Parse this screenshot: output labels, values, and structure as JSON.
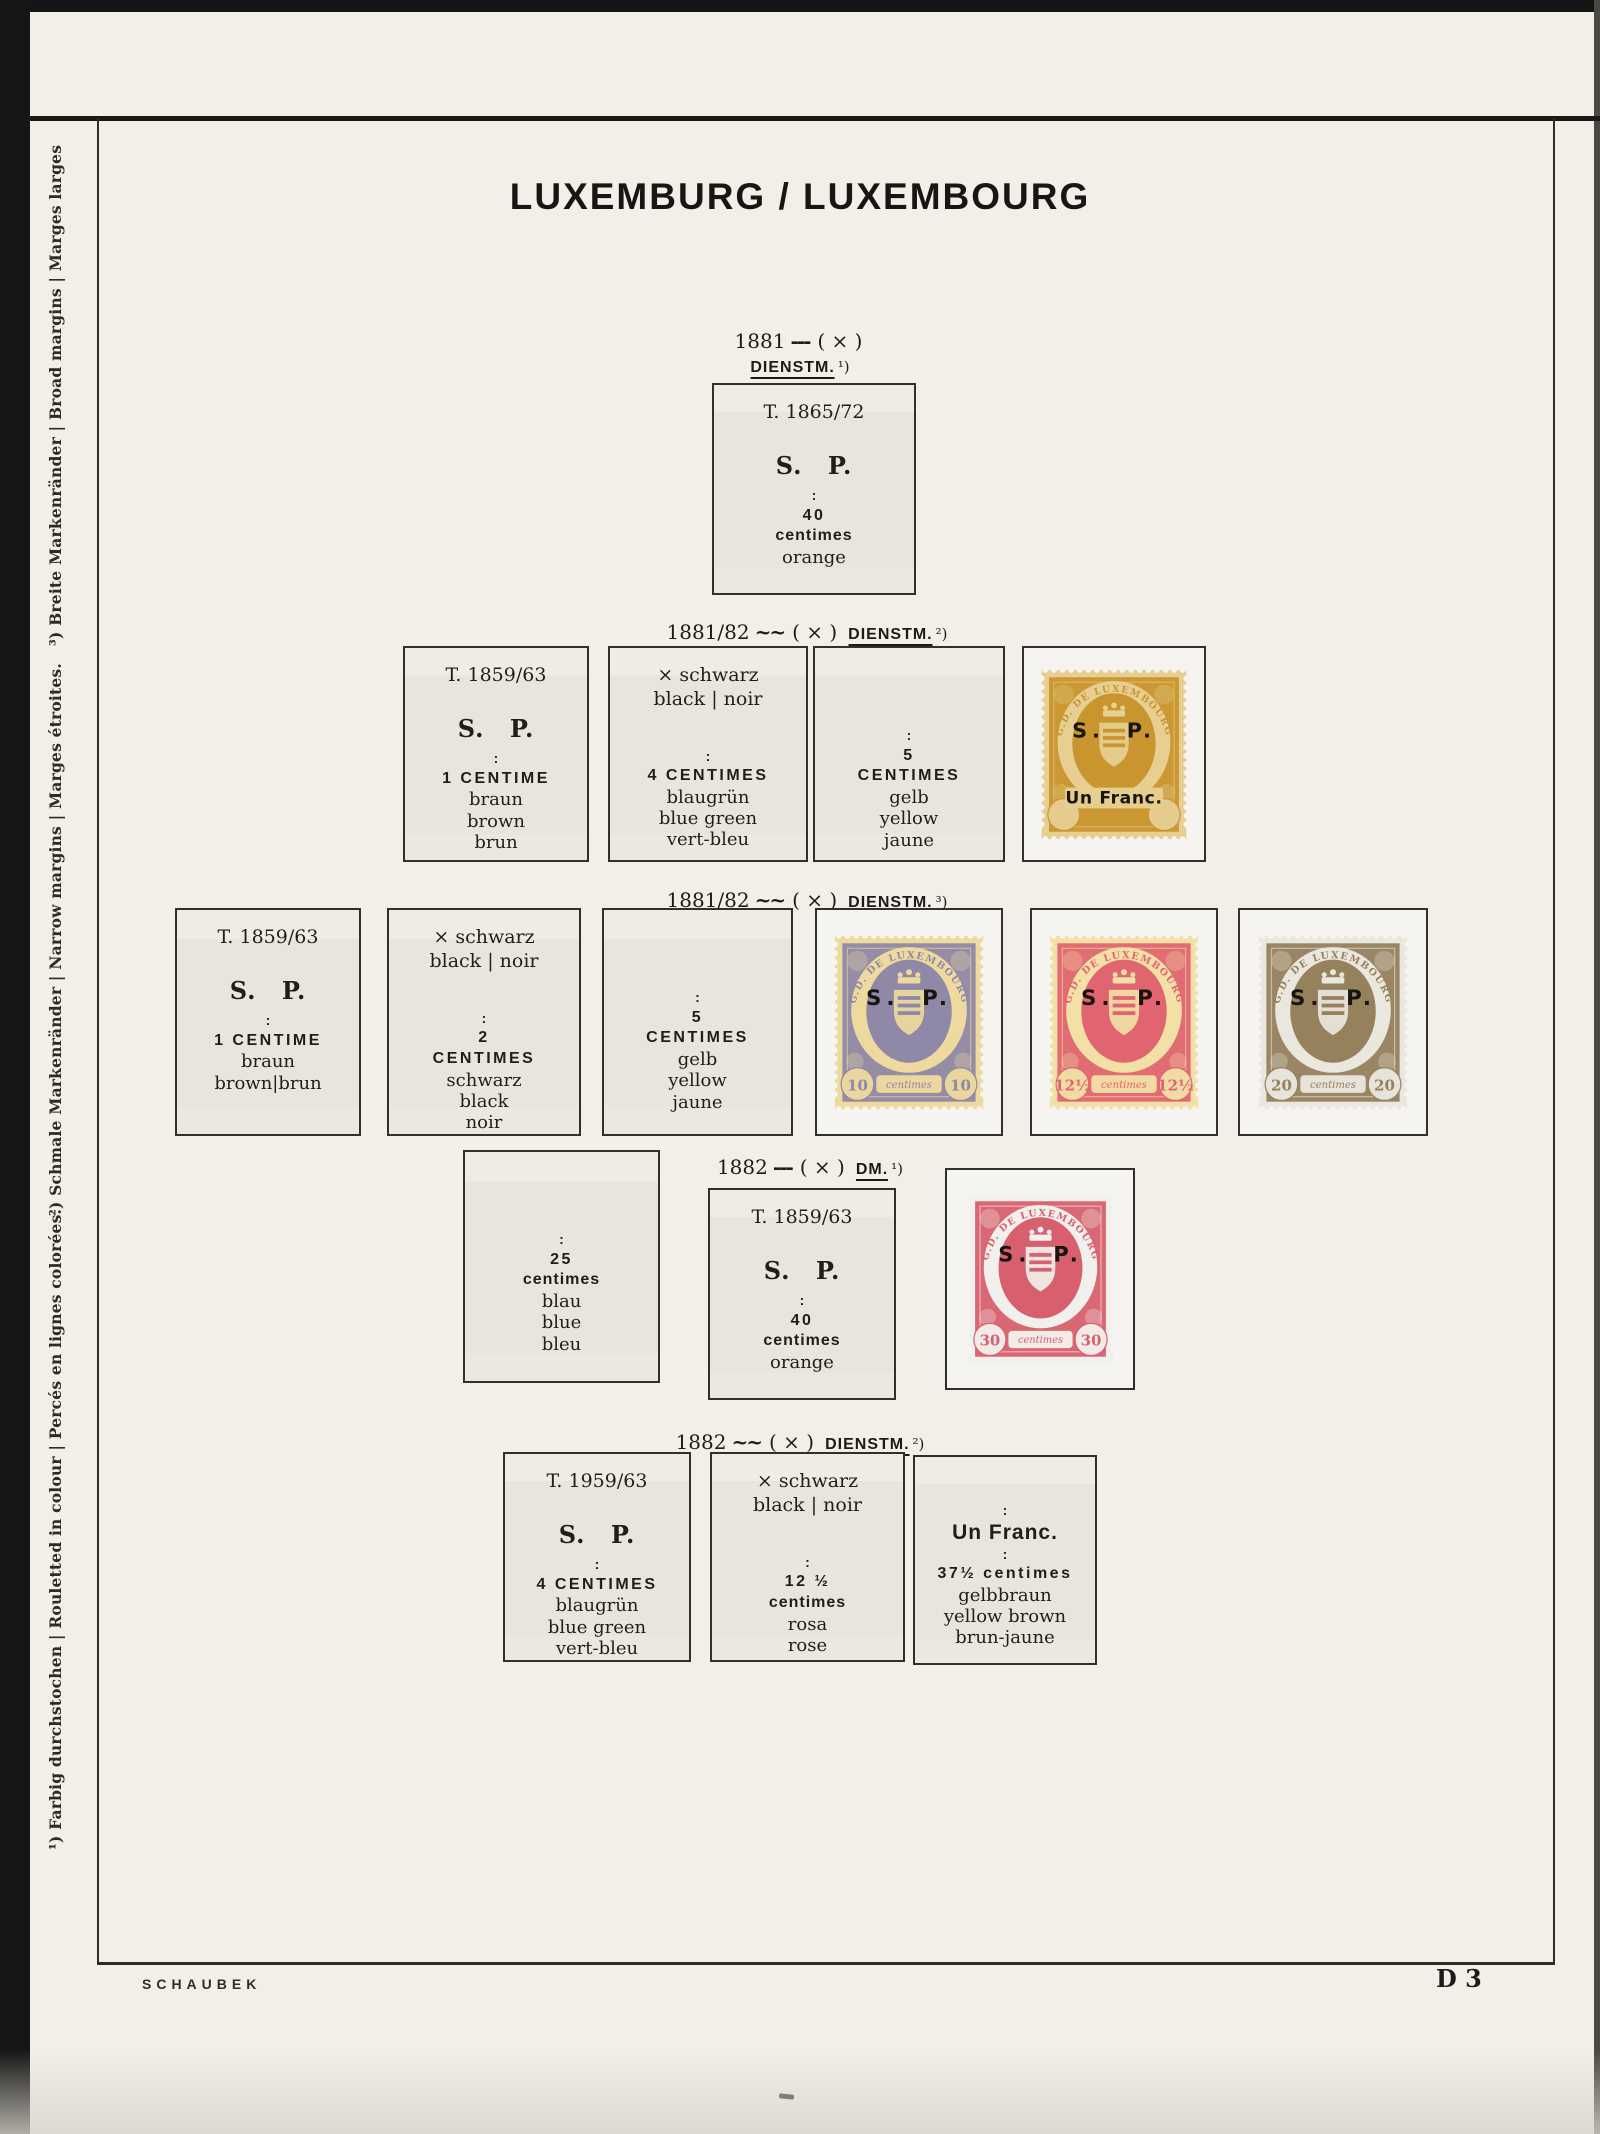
{
  "page": {
    "title": "LUXEMBURG / LUXEMBOURG",
    "publisher": "SCHAUBEK",
    "page_number": "D 3"
  },
  "margin_notes": [
    {
      "text": "¹) Farbig durchstochen  |  Rouletted in colour  |  Percés en lignes colorées."
    },
    {
      "text": "²) Schmale Markenränder  |  Narrow margins  |  Marges étroites."
    },
    {
      "text": "³) Breite Markenränder  |  Broad margins  |  Marges larges"
    }
  ],
  "sections": [
    {
      "header": {
        "date": "1881",
        "sep": "---",
        "perf": "( × )",
        "label": "DIENSTM.",
        "note": "¹)"
      },
      "boxes": [
        {
          "lines": [
            {
              "t": "T. 1865/72",
              "s": "type"
            },
            {
              "t": "S. P.",
              "s": "sp"
            },
            {
              "t": ":",
              "s": "colon"
            },
            {
              "t": "40",
              "s": "val"
            },
            {
              "t": "centimes",
              "s": "vall"
            },
            {
              "t": "orange",
              "s": "plain"
            }
          ]
        }
      ]
    },
    {
      "header": {
        "date": "1881/82",
        "sep": "~~",
        "perf": "( × )",
        "label": "DIENSTM.",
        "note": "²)"
      },
      "boxes": [
        {
          "lines": [
            {
              "t": "T. 1859/63",
              "s": "type"
            },
            {
              "t": "S. P.",
              "s": "sp"
            },
            {
              "t": ":",
              "s": "colon"
            },
            {
              "t": "1 CENTIME",
              "s": "val"
            },
            {
              "t": "braun",
              "s": "plain"
            },
            {
              "t": "brown",
              "s": "plain"
            },
            {
              "t": "brun",
              "s": "plain"
            }
          ]
        },
        {
          "lines": [
            {
              "t": "× schwarz",
              "s": "x"
            },
            {
              "t": "black | noir",
              "s": "x2"
            },
            {
              "t": ":",
              "s": "colon"
            },
            {
              "t": "4 CENTIMES",
              "s": "val"
            },
            {
              "t": "blaugrün",
              "s": "plain"
            },
            {
              "t": "blue green",
              "s": "plain"
            },
            {
              "t": "vert-bleu",
              "s": "plain"
            }
          ]
        },
        {
          "lines": [
            {
              "t": ":",
              "s": "colon"
            },
            {
              "t": "5",
              "s": "val"
            },
            {
              "t": "CENTIMES",
              "s": "val"
            },
            {
              "t": "gelb",
              "s": "plain"
            },
            {
              "t": "yellow",
              "s": "plain"
            },
            {
              "t": "jaune",
              "s": "plain"
            }
          ]
        }
      ]
    },
    {
      "header": {
        "date": "1881/82",
        "sep": "~~",
        "perf": "( × )",
        "label": "DIENSTM.",
        "note": "³)"
      },
      "boxes": [
        {
          "lines": [
            {
              "t": "T. 1859/63",
              "s": "type"
            },
            {
              "t": "S. P.",
              "s": "sp"
            },
            {
              "t": ":",
              "s": "colon"
            },
            {
              "t": "1 CENTIME",
              "s": "val"
            },
            {
              "t": "braun",
              "s": "plain"
            },
            {
              "t": "brown|brun",
              "s": "plain"
            }
          ]
        },
        {
          "lines": [
            {
              "t": "× schwarz",
              "s": "x"
            },
            {
              "t": "black | noir",
              "s": "x2"
            },
            {
              "t": ":",
              "s": "colon"
            },
            {
              "t": "2",
              "s": "val"
            },
            {
              "t": "CENTIMES",
              "s": "val"
            },
            {
              "t": "schwarz",
              "s": "plain"
            },
            {
              "t": "black",
              "s": "plain"
            },
            {
              "t": "noir",
              "s": "plain"
            }
          ]
        },
        {
          "lines": [
            {
              "t": ":",
              "s": "colon"
            },
            {
              "t": "5",
              "s": "val"
            },
            {
              "t": "CENTIMES",
              "s": "val"
            },
            {
              "t": "gelb",
              "s": "plain"
            },
            {
              "t": "yellow",
              "s": "plain"
            },
            {
              "t": "jaune",
              "s": "plain"
            }
          ]
        }
      ]
    },
    {
      "header": {
        "date": "1882",
        "sep": "---",
        "perf": "( × )",
        "label": "DM.",
        "note": "¹)"
      },
      "boxes": [
        {
          "lines": [
            {
              "t": ":",
              "s": "colon"
            },
            {
              "t": "25",
              "s": "val"
            },
            {
              "t": "centimes",
              "s": "vall"
            },
            {
              "t": "blau",
              "s": "plain"
            },
            {
              "t": "blue",
              "s": "plain"
            },
            {
              "t": "bleu",
              "s": "plain"
            }
          ]
        },
        {
          "lines": [
            {
              "t": "T. 1859/63",
              "s": "type"
            },
            {
              "t": "S. P.",
              "s": "sp"
            },
            {
              "t": ":",
              "s": "colon"
            },
            {
              "t": "40",
              "s": "val"
            },
            {
              "t": "centimes",
              "s": "vall"
            },
            {
              "t": "orange",
              "s": "plain"
            }
          ]
        }
      ]
    },
    {
      "header": {
        "date": "1882",
        "sep": "~~",
        "perf": "( × )",
        "label": "DIENSTM.",
        "note": "²)"
      },
      "boxes": [
        {
          "lines": [
            {
              "t": "T. 1959/63",
              "s": "type"
            },
            {
              "t": "S. P.",
              "s": "sp"
            },
            {
              "t": ":",
              "s": "colon"
            },
            {
              "t": "4 CENTIMES",
              "s": "val"
            },
            {
              "t": "blaugrün",
              "s": "plain"
            },
            {
              "t": "blue green",
              "s": "plain"
            },
            {
              "t": "vert-bleu",
              "s": "plain"
            }
          ]
        },
        {
          "lines": [
            {
              "t": "× schwarz",
              "s": "x"
            },
            {
              "t": "black | noir",
              "s": "x2"
            },
            {
              "t": ":",
              "s": "colon"
            },
            {
              "t": "12 ½",
              "s": "val"
            },
            {
              "t": "centimes",
              "s": "vall"
            },
            {
              "t": "rosa",
              "s": "plain"
            },
            {
              "t": "rose",
              "s": "plain"
            }
          ]
        },
        {
          "lines": [
            {
              "t": ":",
              "s": "colon"
            },
            {
              "t": "Un Franc.",
              "s": "unfranc"
            },
            {
              "t": ":",
              "s": "colon"
            },
            {
              "t": "37½ centimes",
              "s": "val"
            },
            {
              "t": "gelbbraun",
              "s": "plain"
            },
            {
              "t": "yellow brown",
              "s": "plain"
            },
            {
              "t": "brun-jaune",
              "s": "plain"
            }
          ]
        }
      ]
    }
  ],
  "stamps": {
    "unfranc": {
      "arc": "G.D. DE LUXEMBOURG",
      "sp": "S. P.",
      "franc": "Un Franc.",
      "value": "",
      "banner": "",
      "ink": "#c9952f",
      "paper": "#e7cf92"
    },
    "c10": {
      "arc": "G.D. DE LUXEMBOURG",
      "sp": "S. P.",
      "value": "10",
      "banner": "centimes",
      "ink": "#8f88a6",
      "paper": "#eeda9e"
    },
    "c12": {
      "arc": "G.D. DE LUXEMBOURG",
      "sp": "S. P.",
      "value": "12½",
      "banner": "centimes",
      "ink": "#e06570",
      "paper": "#f2e0a6"
    },
    "c20": {
      "arc": "G.D. DE LUXEMBOURG",
      "sp": "S. P.",
      "value": "20",
      "banner": "centimes",
      "ink": "#96815d",
      "paper": "#eae7df"
    },
    "c30": {
      "arc": "G.D. DE LUXEMBOURG",
      "sp": "S. P.",
      "value": "30",
      "banner": "centimes",
      "ink": "#d75f6e",
      "paper": "#f2f0ec"
    }
  }
}
